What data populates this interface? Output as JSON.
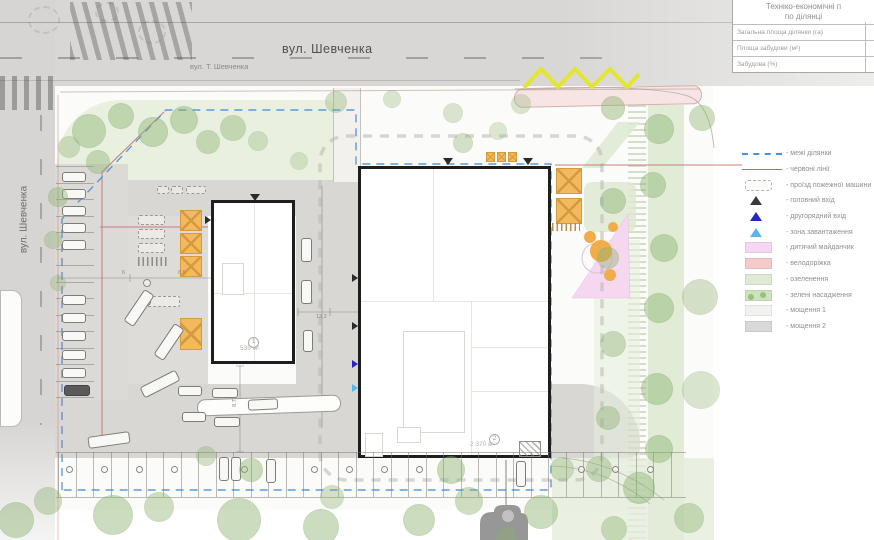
{
  "plan": {
    "streets": {
      "top_label": "вул. Шевченка",
      "top_sublabel": "вул. Т. Шевченка",
      "left_label": "вул. Шевченка"
    },
    "buildings": [
      {
        "number": "1",
        "area_label": "535 м²"
      },
      {
        "number": "2",
        "area_label": "2 370 м²"
      }
    ],
    "dimensions": [
      "3.6",
      "13.2",
      "6",
      "8.5",
      "8.7"
    ]
  },
  "table": {
    "title_line1": "Техніко-економічні п",
    "title_line2": "по ділянці",
    "rows": [
      {
        "label": "Загальна площа ділянки (га)"
      },
      {
        "label": "Площа забудови (м²)"
      },
      {
        "label": "Забудова (%)"
      }
    ]
  },
  "legend": {
    "items": [
      {
        "swatch": "line-dashed",
        "color": "#4d8fd6",
        "label": "- межі ділянки"
      },
      {
        "swatch": "line-solid",
        "color": "#c06a66",
        "label": "- червоні лінії"
      },
      {
        "swatch": "rect-dashed",
        "color": "#b5b5b0",
        "label": "- проїзд пожежної машини"
      },
      {
        "swatch": "triangle",
        "color": "#3a3a3a",
        "label": "- головний вхід"
      },
      {
        "swatch": "triangle",
        "color": "#2526c9",
        "label": "- другорядний вхід"
      },
      {
        "swatch": "triangle",
        "color": "#58b7e8",
        "label": "- зона завантаження"
      },
      {
        "swatch": "rect",
        "color": "#f6d7f3",
        "label": "- дитячий майданчик"
      },
      {
        "swatch": "rect",
        "color": "#f5caca",
        "label": "- велодоріжка"
      },
      {
        "swatch": "rect",
        "color": "#dfe9d4",
        "label": "- озеленення"
      },
      {
        "swatch": "rect-trees",
        "color": "#cfe2c0",
        "label": "- зелені насадження"
      },
      {
        "swatch": "rect",
        "color": "#f2f2f0",
        "label": "- мощення 1"
      },
      {
        "swatch": "rect",
        "color": "#d9d9d9",
        "label": "- мощення 2"
      }
    ]
  },
  "colors": {
    "boundary_blue": "#4d8fd6",
    "red_line": "#c06a66",
    "canopy_orange": "#f2b95f",
    "playground_pink": "#f6d4f1",
    "lawn_green": "#dce8d0",
    "road_gray": "#d8d7d5",
    "accent_yellow": "#e3e62e"
  }
}
